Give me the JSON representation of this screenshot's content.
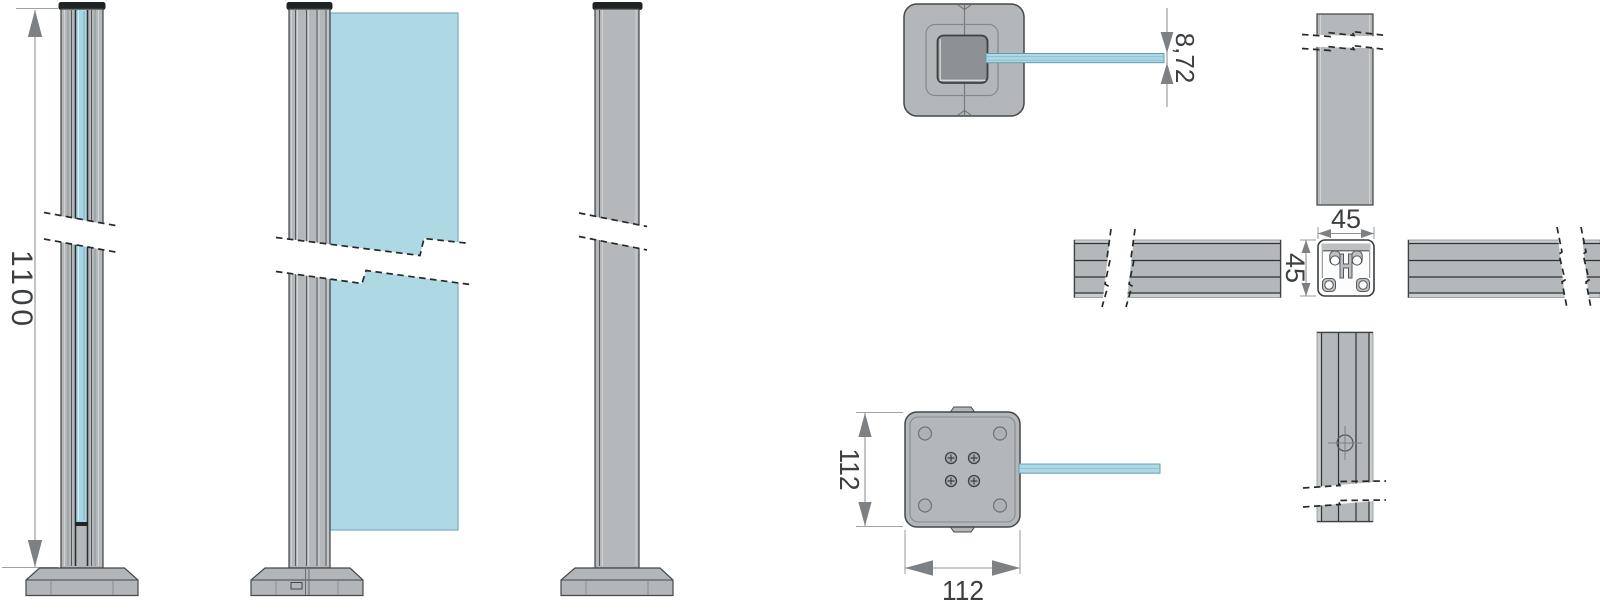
{
  "drawing": {
    "dimensions": {
      "post_height": "1100",
      "glass_thickness": "8,72",
      "profile_width": "45",
      "profile_height": "45",
      "baseplate_depth": "112",
      "baseplate_width": "112"
    },
    "colors": {
      "background": "#ffffff",
      "profile_gray": "#b4b8ba",
      "glass_blue": "#aed8e4",
      "cap_dark": "#202324",
      "outline": "#3f4243",
      "dimension_line": "#8f9395",
      "arrow": "#7d8184",
      "text": "#3c3f41"
    }
  }
}
